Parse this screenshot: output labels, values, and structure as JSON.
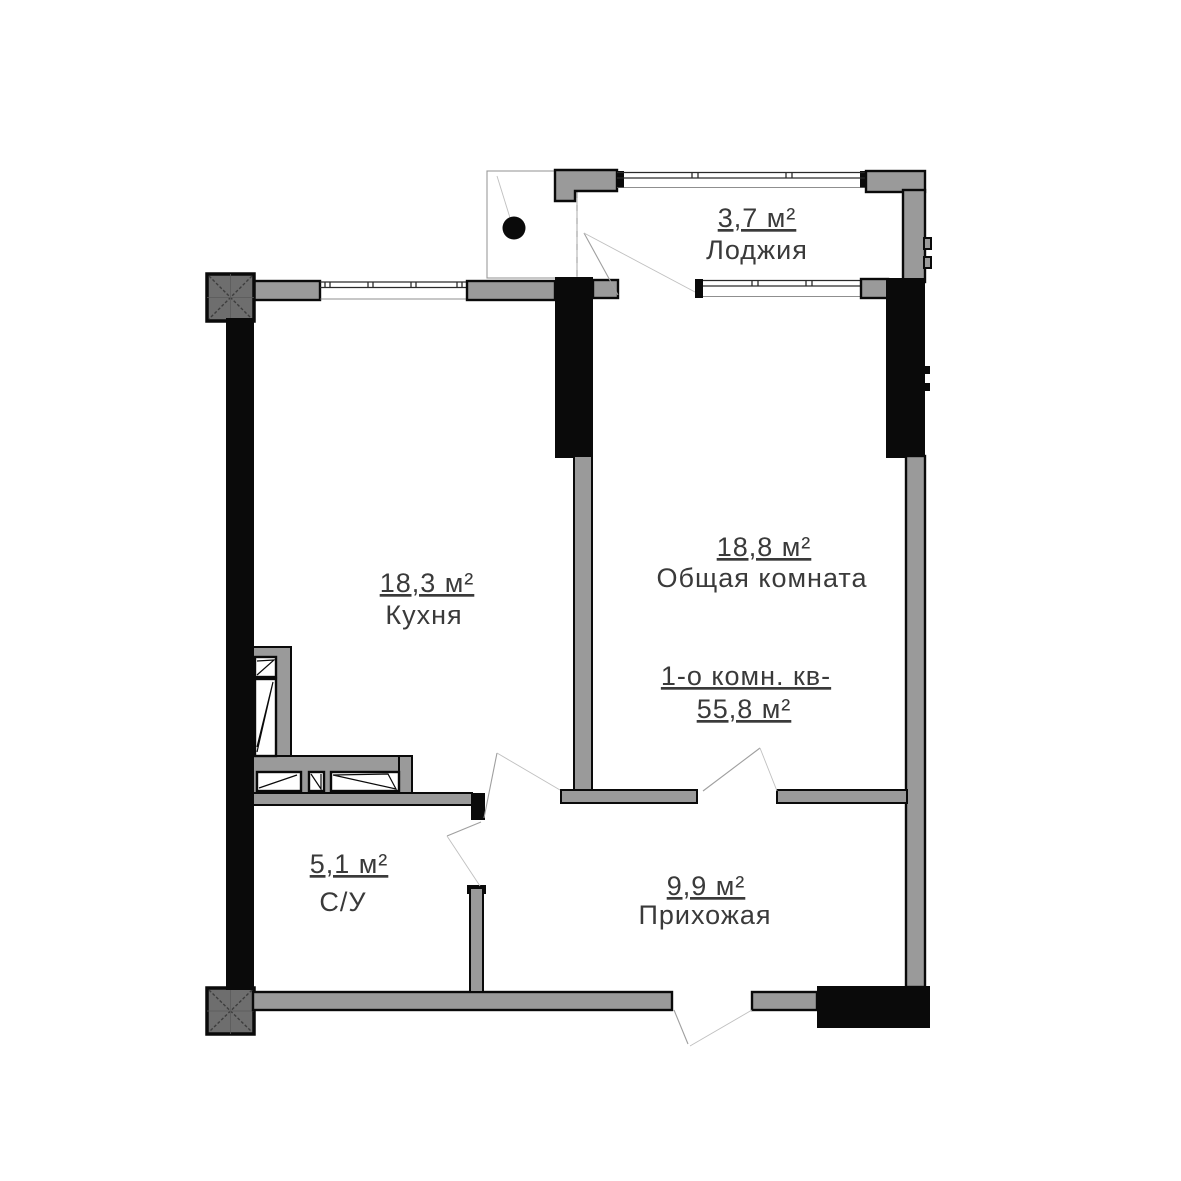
{
  "plan": {
    "apartment": {
      "title": "1-о комн. кв-",
      "total_area": "55,8 м²"
    },
    "rooms": {
      "loggia": {
        "area": "3,7 м²",
        "name": "Лоджия"
      },
      "kitchen": {
        "area": "18,3 м²",
        "name": "Кухня"
      },
      "living": {
        "area": "18,8 м²",
        "name": "Общая комната"
      },
      "bath": {
        "area": "5,1 м²",
        "name": "С/У"
      },
      "hall": {
        "area": "9,9 м²",
        "name": "Прихожая"
      }
    },
    "colors": {
      "background": "#ffffff",
      "wall_gray": "#9a9a9a",
      "column_gray": "#6e6e6e",
      "wall_black": "#0a0a0a",
      "text": "#3a3a3a"
    }
  }
}
